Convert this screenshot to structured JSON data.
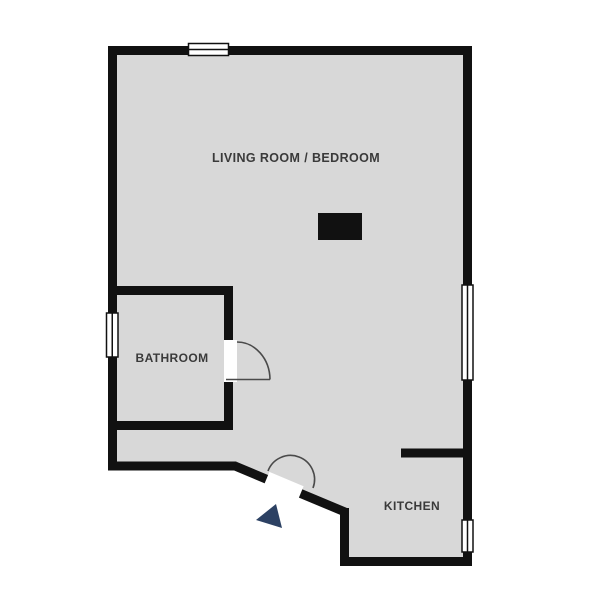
{
  "plan": {
    "type": "apartment-floor-plan",
    "rooms": [
      {
        "label": "LIVING ROOM / BEDROOM"
      },
      {
        "label": "BATHROOM"
      },
      {
        "label": "KITCHEN"
      }
    ],
    "symbols": {
      "windows": [
        "top-wall-window",
        "bathroom-left-window",
        "living-right-window",
        "kitchen-right-window"
      ],
      "doors": [
        "bathroom-door",
        "entrance-door"
      ],
      "furniture": [
        "furniture-block"
      ],
      "markers": [
        "entrance-arrow"
      ]
    }
  },
  "colors": {
    "background": "#ffffff",
    "floor": "#d8d8d8",
    "wall": "#111111",
    "label_text": "#3a3a3a",
    "door_arc": "#4a4a4a",
    "entrance_arrow": "#2c4163",
    "furniture": "#111111",
    "window_fill": "#ffffff"
  }
}
